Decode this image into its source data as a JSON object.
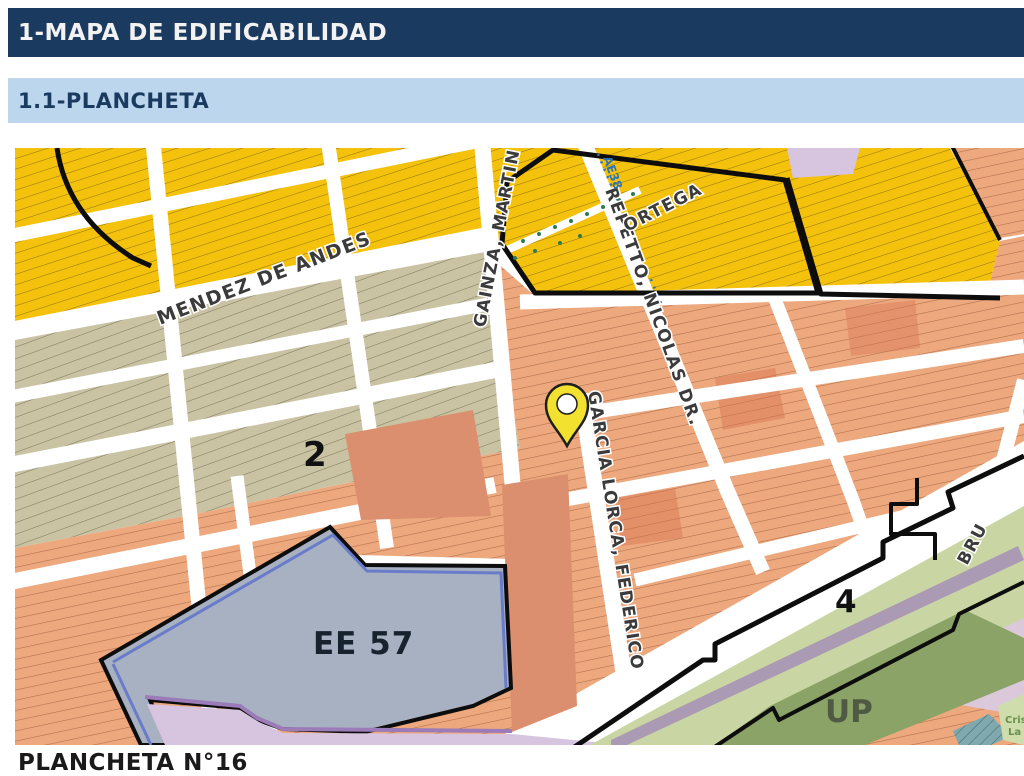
{
  "header": {
    "title": "1-MAPA DE EDIFICABILIDAD"
  },
  "subheader": {
    "title": "1.1-PLANCHETA"
  },
  "map": {
    "streets": {
      "mendez": "MENDEZ DE ANDES",
      "gainza": "GAINZA, MARTIN",
      "repetto": "REPETTO, NICOLAS DR.",
      "garcia": "GARCIA LORCA, FEDERICO",
      "ortega": "ORTEGA",
      "bru": "BRU"
    },
    "labels": {
      "zone2": "2",
      "ee57": "EE 57",
      "zone4": "4",
      "up": "UP",
      "ae": "AE38",
      "criso1": "Crisó",
      "criso2": "La"
    },
    "colors": {
      "yellow": "#F4C20C",
      "beige": "#C9C3A3",
      "salmon": "#EDA87D",
      "salmon_plain": "#DC8F6E",
      "ee57_gray": "#A7B1C2",
      "lavender": "#D7C5DF",
      "green_corridor": "#C9D6A4",
      "up_green": "#8BA367",
      "rail_mauve": "#AB9AB3",
      "teal": "#7FA9AF",
      "pin_yellow": "#F2E12E",
      "boundary_black": "#0D0D0D",
      "ae_blue": "#2E74B5",
      "ee57_blue_line": "#6A7CC9",
      "ee57_purple_line": "#9B7CB8"
    }
  },
  "caption": {
    "text": "PLANCHETA N°16"
  }
}
